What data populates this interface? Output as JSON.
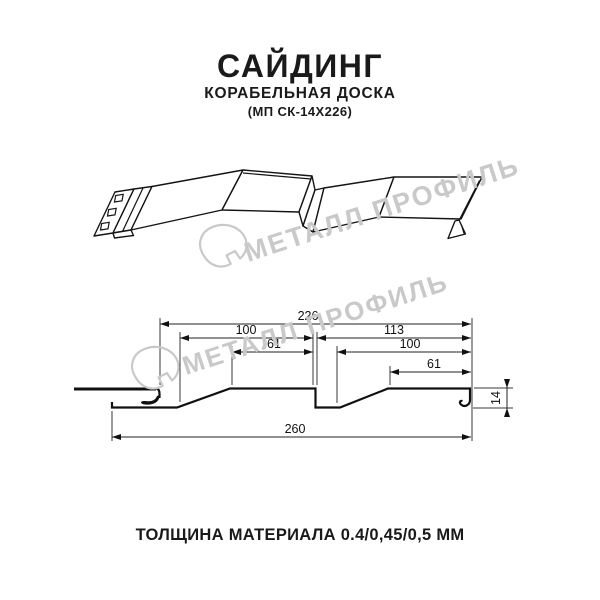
{
  "header": {
    "title": "САЙДИНГ",
    "subtitle": "КОРАБЕЛЬНАЯ ДОСКА",
    "model": "(МП СК-14Х226)"
  },
  "watermark": {
    "text": "МЕТАЛЛ ПРОФИЛЬ"
  },
  "drawing": {
    "dimensions": {
      "total_width": "226",
      "left_panel": "100",
      "right_panel": "113",
      "left_panel_top": "61",
      "right_panel_inner": "100",
      "right_panel_top": "61",
      "overall_width": "260",
      "height": "14"
    }
  },
  "footer": {
    "thickness": "ТОЛЩИНА МАТЕРИАЛА 0.4/0,45/0,5 ММ"
  }
}
